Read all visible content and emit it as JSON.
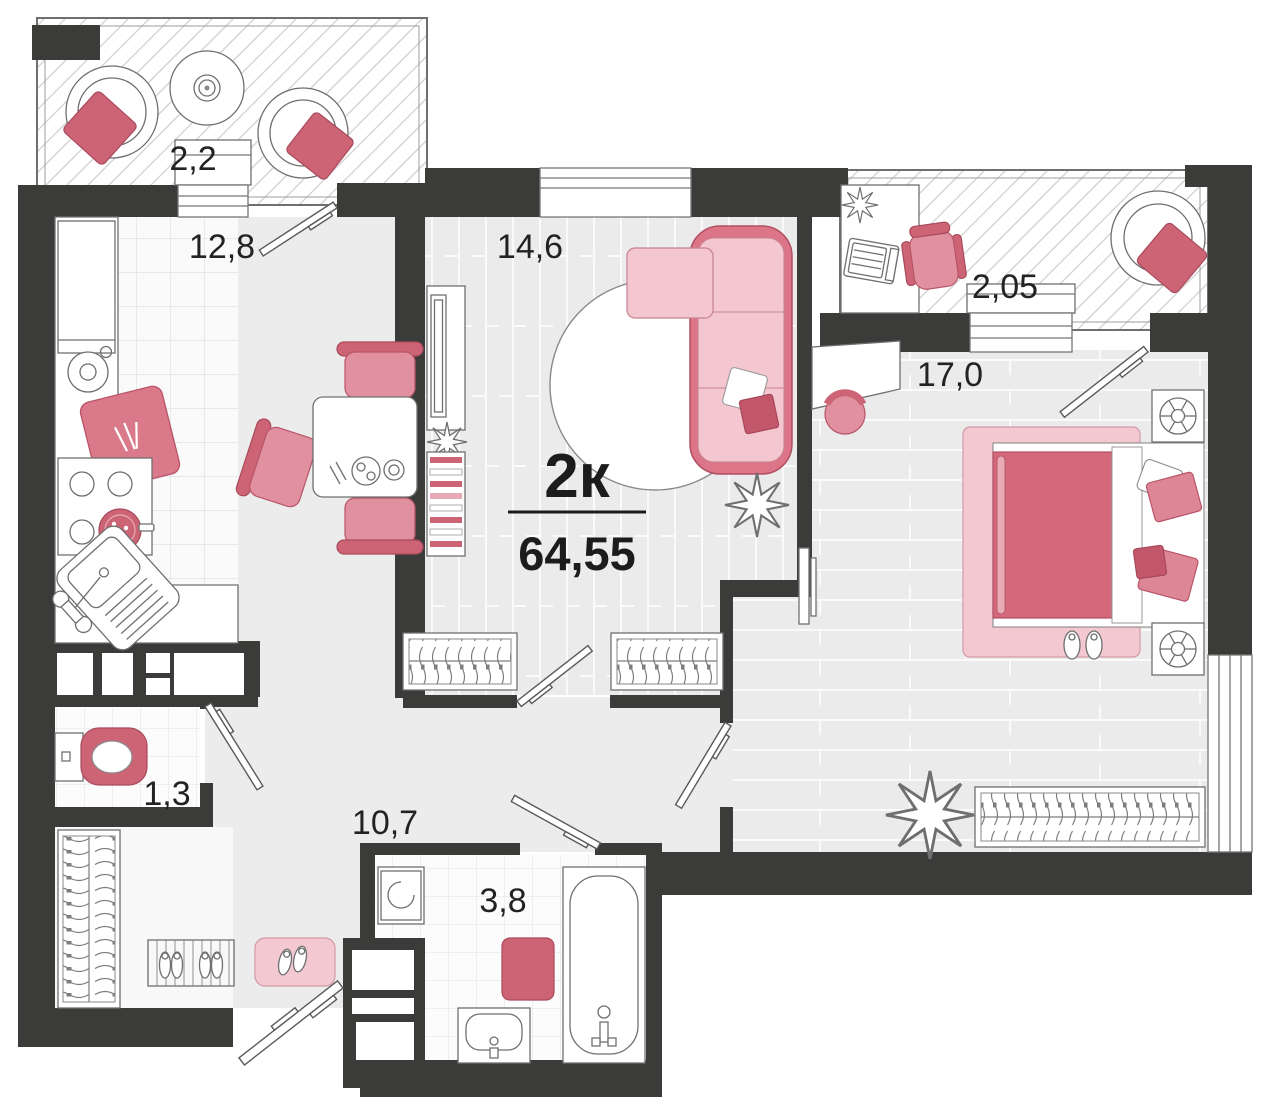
{
  "plan": {
    "unit_type": "2к",
    "total_area": "64,55",
    "rooms": [
      {
        "id": "balcony-top-left",
        "area": "2,2"
      },
      {
        "id": "kitchen",
        "area": "12,8"
      },
      {
        "id": "living-room",
        "area": "14,6"
      },
      {
        "id": "balcony-top-right",
        "area": "2,05"
      },
      {
        "id": "bedroom",
        "area": "17,0"
      },
      {
        "id": "toilet",
        "area": "1,3"
      },
      {
        "id": "hallway",
        "area": "10,7"
      },
      {
        "id": "bathroom",
        "area": "3,8"
      }
    ],
    "colors": {
      "wall": "#3b3b39",
      "floor_gray": "#ececec",
      "rose_light": "#f3c8d0",
      "rose_mid": "#e0909e",
      "rose_dark": "#cd6476",
      "label_text": "#222222"
    }
  }
}
